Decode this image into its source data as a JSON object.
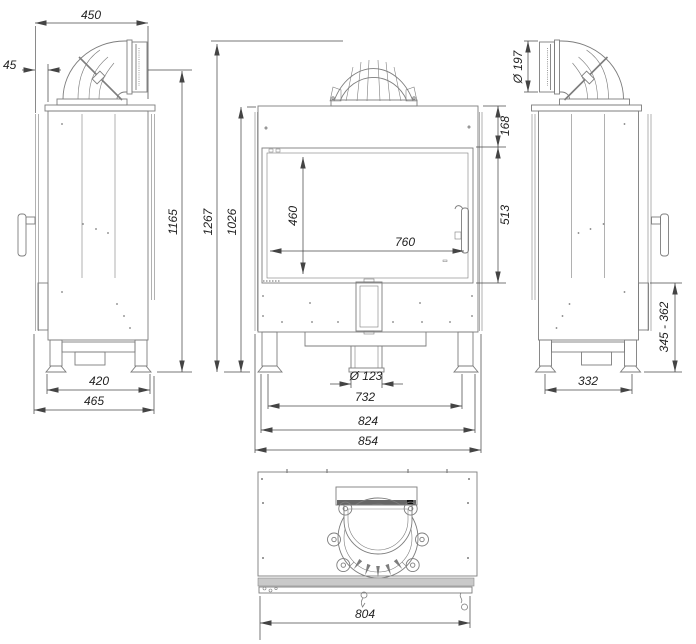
{
  "drawing": {
    "side_view_left": {
      "dim_top_depth": "450",
      "dim_flue_offset": "45",
      "dim_flue_outlet_height": "1165",
      "dim_feet_spacing": "420",
      "dim_total_depth": "465"
    },
    "front_view": {
      "dim_total_height": "1267",
      "dim_body_height": "1026",
      "dim_top_to_glass": "168",
      "dim_glass_frame_height": "513",
      "dim_glass_height": "460",
      "dim_glass_width": "760",
      "dim_air_inlet_diameter": "Ø 123",
      "dim_feet_spacing": "732",
      "dim_legs_width": "824",
      "dim_total_width": "854"
    },
    "side_view_right": {
      "dim_flue_diameter": "Ø 197",
      "dim_base_height_range": "345 - 362",
      "dim_feet_spacing": "332"
    },
    "top_view": {
      "dim_total_width": "804"
    }
  }
}
